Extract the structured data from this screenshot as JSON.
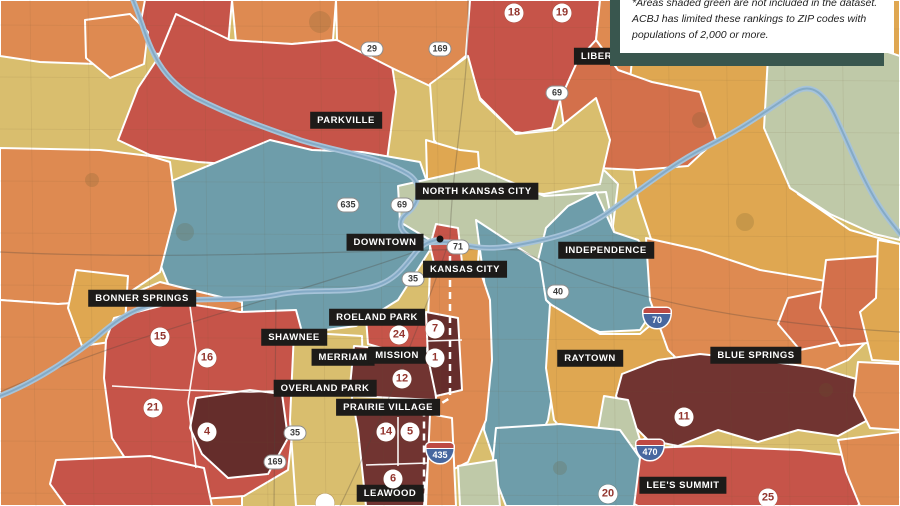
{
  "note": {
    "text": "*Areas shaded green are not included in the dataset. ACBJ has limited these rankings to ZIP codes with populations of 2,000 or more."
  },
  "palette": {
    "tan": "#D9BE6E",
    "gold": "#DFA751",
    "orange": "#DE8A51",
    "orangeDeep": "#D3704B",
    "red": "#C65449",
    "maroon": "#713431",
    "maroonDark": "#652D2B",
    "teal": "#6E9DAA",
    "sage": "#BFC9A8",
    "river": "#A6C3D9",
    "riverCore": "#84AAC6",
    "labelBg": "#1D1B19",
    "labelText": "#FFFFFF",
    "rankText": "#93352E",
    "border": "#FFFFFF"
  },
  "map": {
    "regions": [
      {
        "fill": "orange",
        "points": "0,0 145,0 142,52 96,64 40,62 0,56"
      },
      {
        "fill": "red",
        "points": "145,0 232,0 228,46 156,54 140,26"
      },
      {
        "fill": "orange",
        "points": "232,0 336,0 333,40 292,44 236,42"
      },
      {
        "fill": "orange",
        "points": "85,20 130,14 148,32 144,64 110,78 86,58"
      },
      {
        "fill": "red",
        "points": "176,14 230,40 292,44 336,40 390,52 396,92 386,168 322,178 256,166 198,162 150,155 118,140 138,88 158,58"
      },
      {
        "fill": "orange",
        "points": "336,0 470,0 468,54 430,86 392,68 337,40"
      },
      {
        "fill": "red",
        "points": "470,0 600,0 596,40 578,60 560,100 552,128 516,134 480,98 466,54"
      },
      {
        "fill": "orange",
        "points": "600,0 758,0 754,58 700,92 652,82 618,70 596,40"
      },
      {
        "fill": "gold",
        "points": "758,0 900,0 900,58 870,48 808,62 768,56"
      },
      {
        "fill": "gold",
        "points": "632,60 768,56 766,130 798,194 850,230 900,244 900,332 846,324 798,332 758,312 700,300 658,260 638,200 626,120"
      },
      {
        "fill": "sage",
        "points": "768,56 870,46 900,56 900,240 874,234 830,214 790,188 764,128"
      },
      {
        "fill": "orangeDeep",
        "points": "560,100 578,60 596,40 618,70 652,82 700,92 716,140 688,166 638,170 598,168 566,140"
      },
      {
        "fill": "sage",
        "points": "516,132 566,140 606,172 618,184 612,234 584,204 552,214 528,190 512,160"
      },
      {
        "fill": "teal",
        "points": "150,190 270,140 312,150 362,152 420,162 432,196 430,250 398,300 356,326 296,334 228,326 174,298 156,254 146,214"
      },
      {
        "fill": "tan",
        "points": "430,84 468,56 480,100 516,134 556,130 596,98 610,140 600,184 544,194 498,190 458,174 434,140"
      },
      {
        "fill": "gold",
        "points": "426,140 460,150 478,152 482,210 478,262 458,268 438,262 428,214"
      },
      {
        "fill": "sage",
        "points": "398,186 478,168 544,196 606,192 614,232 586,258 538,262 498,250 462,244 430,240 400,222"
      },
      {
        "fill": "teal",
        "points": "596,192 614,232 638,240 654,260 660,300 640,330 600,332 568,320 546,300 538,260 546,228 568,206"
      },
      {
        "fill": "teal",
        "points": "476,220 540,262 546,300 568,322 558,360 548,420 528,462 498,472 484,430 490,340 484,280"
      },
      {
        "fill": "gold",
        "points": "550,304 600,334 640,334 666,312 680,342 676,402 658,432 618,452 580,450 554,420 546,368"
      },
      {
        "fill": "orange",
        "points": "646,238 700,250 760,270 820,280 868,290 878,330 848,360 798,382 748,392 698,380 668,350 650,300"
      },
      {
        "fill": "orangeDeep",
        "points": "788,298 838,288 860,310 848,340 800,350 778,324"
      },
      {
        "fill": "orangeDeep",
        "points": "826,260 880,256 888,300 876,342 840,346 820,308"
      },
      {
        "fill": "gold",
        "points": "878,240 900,244 900,362 872,360 860,312 876,298"
      },
      {
        "fill": "red",
        "points": "436,224 458,228 462,262 454,276 436,272 430,246"
      },
      {
        "fill": "orange",
        "points": "430,268 478,264 490,300 492,360 486,420 468,462 448,472 430,462 426,380 428,320"
      },
      {
        "fill": "maroon",
        "points": "622,374 658,360 700,354 758,360 818,368 860,380 868,420 838,436 798,430 758,442 718,430 678,446 648,440 628,420 616,396"
      },
      {
        "fill": "sage",
        "points": "604,396 628,400 640,440 634,472 608,468 598,430"
      },
      {
        "fill": "red",
        "points": "594,450 700,446 800,450 852,456 870,480 858,506 638,506 608,490 594,470"
      },
      {
        "fill": "orange",
        "points": "858,362 900,364 900,430 870,428 854,396"
      },
      {
        "fill": "orange",
        "points": "838,440 900,432 900,506 860,506 846,472"
      },
      {
        "fill": "orange",
        "points": "0,148 100,150 150,156 170,162 176,210 160,272 118,300 58,304 0,300"
      },
      {
        "fill": "orange",
        "points": "0,300 58,304 118,300 160,282 200,292 242,302 242,506 0,506"
      },
      {
        "fill": "gold",
        "points": "76,270 128,276 124,340 82,346 68,308"
      },
      {
        "fill": "red",
        "points": "114,318 176,302 240,312 296,310 302,332 296,400 288,470 244,496 188,500 138,478 112,438 104,378 106,340"
      },
      {
        "fill": "maroonDark",
        "points": "196,398 250,390 282,394 288,438 268,474 228,478 202,454 190,428"
      },
      {
        "fill": "red",
        "points": "56,460 150,456 204,468 212,506 66,506 50,484"
      },
      {
        "fill": "tan",
        "points": "294,332 362,336 366,506 296,506 290,420"
      },
      {
        "fill": "red",
        "points": "366,318 428,314 432,348 396,352 368,344"
      },
      {
        "fill": "maroon",
        "points": "354,346 432,352 436,398 428,462 424,506 366,506 358,430 350,386"
      },
      {
        "fill": "maroonDark",
        "points": "426,312 458,318 462,390 436,396 428,358"
      },
      {
        "fill": "tan",
        "points": "352,396 436,400 436,414 352,410"
      },
      {
        "fill": "orange",
        "points": "430,414 452,418 456,506 426,506"
      },
      {
        "fill": "teal",
        "points": "496,428 560,424 620,430 640,458 634,506 506,506 492,470"
      },
      {
        "fill": "sage",
        "points": "458,466 496,460 500,506 460,506"
      }
    ],
    "rivers": [
      "M 133,0 C 148,36 152,74 196,98 C 236,118 266,128 300,140 C 338,152 378,156 408,174 C 424,184 420,204 406,214 C 398,221 398,231 412,238 C 426,246 442,240 456,243 C 472,247 486,250 512,246 C 546,240 576,234 606,214 C 640,190 672,164 706,147 C 740,130 762,114 792,94 C 812,80 826,94 838,122 C 852,152 862,178 878,204 C 888,220 896,228 900,234",
      "M 0,396 C 40,380 70,358 96,338 C 116,320 136,306 166,302 C 200,297 240,302 276,295 C 310,288 342,294 372,287 C 396,281 406,264 416,252 C 423,244 428,242 436,240"
    ],
    "roads": [
      "M 340,506 C 382,420 430,300 450,238 C 452,158 470,88 468,0",
      "M 0,252 C 200,262 430,246 520,250 C 560,270 658,318 900,332",
      "M 0,392 C 140,330 280,300 420,250",
      "M 274,506 L 276,300"
    ],
    "dividers": [
      "190,306 196,350 188,402 196,468",
      "112,386 180,390 250,392 298,390",
      "428,341 462,340",
      "398,417 398,466",
      "366,465 428,463"
    ],
    "state_line": "450,256 450,398 424,414 424,506",
    "parks": [
      {
        "cx": 320,
        "cy": 22,
        "r": 11
      },
      {
        "cx": 700,
        "cy": 120,
        "r": 8
      },
      {
        "cx": 185,
        "cy": 232,
        "r": 9
      },
      {
        "cx": 826,
        "cy": 390,
        "r": 7
      },
      {
        "cx": 560,
        "cy": 468,
        "r": 7
      },
      {
        "cx": 92,
        "cy": 180,
        "r": 7
      },
      {
        "cx": 745,
        "cy": 222,
        "r": 9
      }
    ],
    "city_dot": {
      "x": 440,
      "y": 239
    }
  },
  "city_labels": [
    {
      "name": "liberty",
      "label": "LIBERTY",
      "x": 603,
      "y": 56
    },
    {
      "name": "parkville",
      "label": "PARKVILLE",
      "x": 346,
      "y": 120
    },
    {
      "name": "north-kansas-city",
      "label": "NORTH KANSAS CITY",
      "x": 477,
      "y": 191
    },
    {
      "name": "downtown",
      "label": "DOWNTOWN",
      "x": 385,
      "y": 242
    },
    {
      "name": "kansas-city",
      "label": "KANSAS CITY",
      "x": 465,
      "y": 269
    },
    {
      "name": "independence",
      "label": "INDEPENDENCE",
      "x": 606,
      "y": 250
    },
    {
      "name": "bonner-springs",
      "label": "BONNER SPRINGS",
      "x": 142,
      "y": 298
    },
    {
      "name": "roeland-park",
      "label": "ROELAND PARK",
      "x": 377,
      "y": 317
    },
    {
      "name": "shawnee",
      "label": "SHAWNEE",
      "x": 294,
      "y": 337
    },
    {
      "name": "merriam",
      "label": "MERRIAM",
      "x": 343,
      "y": 357
    },
    {
      "name": "mission",
      "label": "MISSION",
      "x": 397,
      "y": 355
    },
    {
      "name": "overland-park",
      "label": "OVERLAND PARK",
      "x": 325,
      "y": 388
    },
    {
      "name": "prairie-village",
      "label": "PRAIRIE VILLAGE",
      "x": 388,
      "y": 407
    },
    {
      "name": "raytown",
      "label": "RAYTOWN",
      "x": 590,
      "y": 358
    },
    {
      "name": "blue-springs",
      "label": "BLUE SPRINGS",
      "x": 756,
      "y": 355
    },
    {
      "name": "leawood",
      "label": "LEAWOOD",
      "x": 390,
      "y": 493
    },
    {
      "name": "lees-summit",
      "label": "LEE'S SUMMIT",
      "x": 683,
      "y": 485
    }
  ],
  "rank_markers": [
    {
      "value": "18",
      "x": 514,
      "y": 13
    },
    {
      "value": "19",
      "x": 562,
      "y": 13
    },
    {
      "value": "15",
      "x": 160,
      "y": 337
    },
    {
      "value": "16",
      "x": 207,
      "y": 358
    },
    {
      "value": "21",
      "x": 153,
      "y": 408
    },
    {
      "value": "4",
      "x": 207,
      "y": 432
    },
    {
      "value": "24",
      "x": 399,
      "y": 335
    },
    {
      "value": "7",
      "x": 435,
      "y": 329
    },
    {
      "value": "1",
      "x": 435,
      "y": 358
    },
    {
      "value": "12",
      "x": 402,
      "y": 379
    },
    {
      "value": "14",
      "x": 386,
      "y": 432
    },
    {
      "value": "5",
      "x": 410,
      "y": 432
    },
    {
      "value": "6",
      "x": 393,
      "y": 479
    },
    {
      "value": "11",
      "x": 684,
      "y": 417
    },
    {
      "value": "20",
      "x": 608,
      "y": 494
    },
    {
      "value": "25",
      "x": 768,
      "y": 498
    },
    {
      "value": "",
      "x": 325,
      "y": 503
    }
  ],
  "highway_shields": [
    {
      "style": "us",
      "number": "29",
      "x": 372,
      "y": 49
    },
    {
      "style": "us",
      "number": "169",
      "x": 440,
      "y": 49
    },
    {
      "style": "us",
      "number": "69",
      "x": 557,
      "y": 93
    },
    {
      "style": "us",
      "number": "635",
      "x": 348,
      "y": 205
    },
    {
      "style": "us",
      "number": "69",
      "x": 402,
      "y": 205
    },
    {
      "style": "us",
      "number": "71",
      "x": 458,
      "y": 247
    },
    {
      "style": "us",
      "number": "35",
      "x": 413,
      "y": 279
    },
    {
      "style": "us",
      "number": "40",
      "x": 558,
      "y": 292
    },
    {
      "style": "interstate",
      "number": "70",
      "x": 657,
      "y": 318
    },
    {
      "style": "us",
      "number": "35",
      "x": 295,
      "y": 433
    },
    {
      "style": "us",
      "number": "169",
      "x": 275,
      "y": 462
    },
    {
      "style": "interstate",
      "number": "435",
      "x": 440,
      "y": 453
    },
    {
      "style": "interstate",
      "number": "470",
      "x": 650,
      "y": 450
    }
  ]
}
